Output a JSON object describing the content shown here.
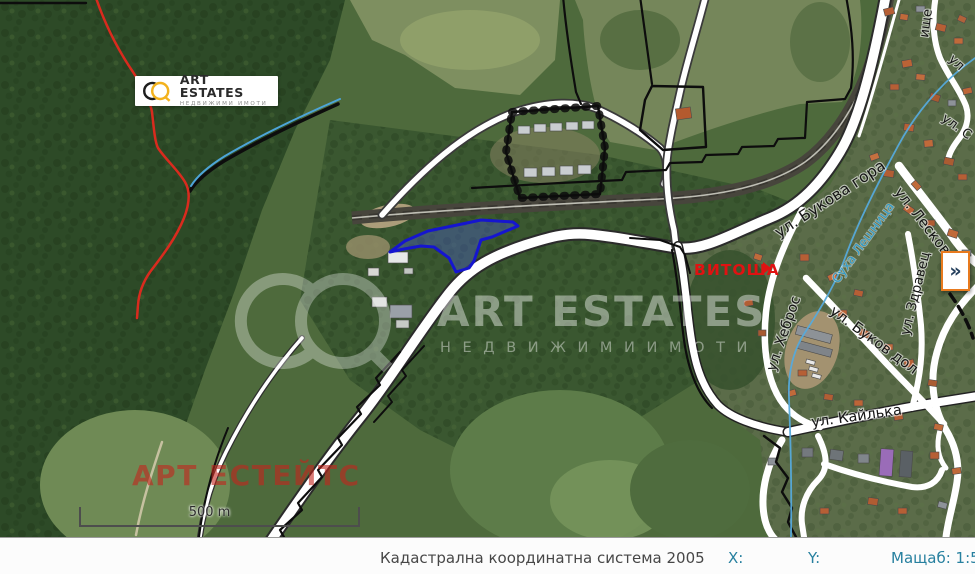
{
  "logo_card": {
    "brand": "ART ESTATES",
    "tagline": "НЕДВИЖИМИ ИМОТИ"
  },
  "watermark": {
    "brand": "ART ESTATES",
    "tagline": "Н Е Д В И Ж И М И   И М О Т И",
    "brand_cyrillic": "АРТ ЕСТЕЙТС"
  },
  "map": {
    "place_labels": {
      "vitosha": "ВИТОША"
    },
    "river_label": "Суха Лешница",
    "street_labels": {
      "bukova_gora": "ул. Букова гора",
      "leskovets": "ул. Лесковец",
      "zdravets": "ул. Здравец",
      "hebros": "ул. Хеброс",
      "bukov_dol": "ул. Буков дол",
      "kaylaka": "ул. Кайлька",
      "fragment_top": "ище",
      "fragment_ul": "ул",
      "fragment_ul_s": "ул. С"
    },
    "scale_bar": {
      "label": "500 m"
    },
    "highlight_color": "#1515cf"
  },
  "panel_toggle": {
    "glyph": "»"
  },
  "status_bar": {
    "crs": "Кадастрална координатна система 2005",
    "x_label": "X:",
    "y_label": "Y:",
    "scale": "Мащаб: 1:5 000"
  }
}
